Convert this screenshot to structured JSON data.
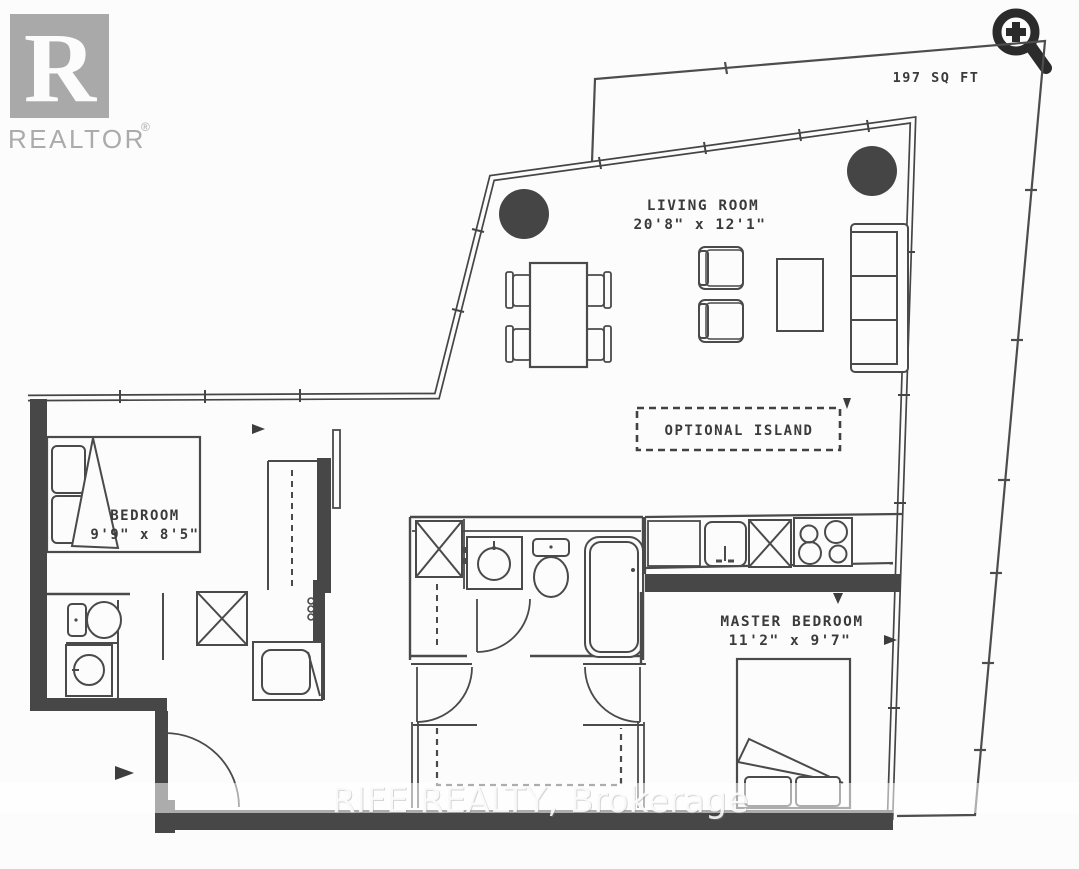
{
  "branding": {
    "logo_letter": "R",
    "logo_text": "REALTOR",
    "registered_mark": "®"
  },
  "toolbar": {
    "zoom_icon": "zoom-in-magnifier"
  },
  "floorplan": {
    "balcony_area_label": "197 SQ FT",
    "rooms": [
      {
        "name": "LIVING ROOM",
        "dims": "20'8\" x 12'1\""
      },
      {
        "name": "BEDROOM",
        "dims": "9'9\" x 8'5\""
      },
      {
        "name": "MASTER BEDROOM",
        "dims": "11'2\" x 9'7\""
      }
    ],
    "optional_island_label": "OPTIONAL ISLAND"
  },
  "watermark": {
    "text": "RIFE REALTY, Brokerage"
  },
  "colors": {
    "wall": "#474747",
    "line": "#454545",
    "logo_gray": "#a9a9a9",
    "icon_dark": "#2b2b2b",
    "background": "#fcfcfc"
  }
}
